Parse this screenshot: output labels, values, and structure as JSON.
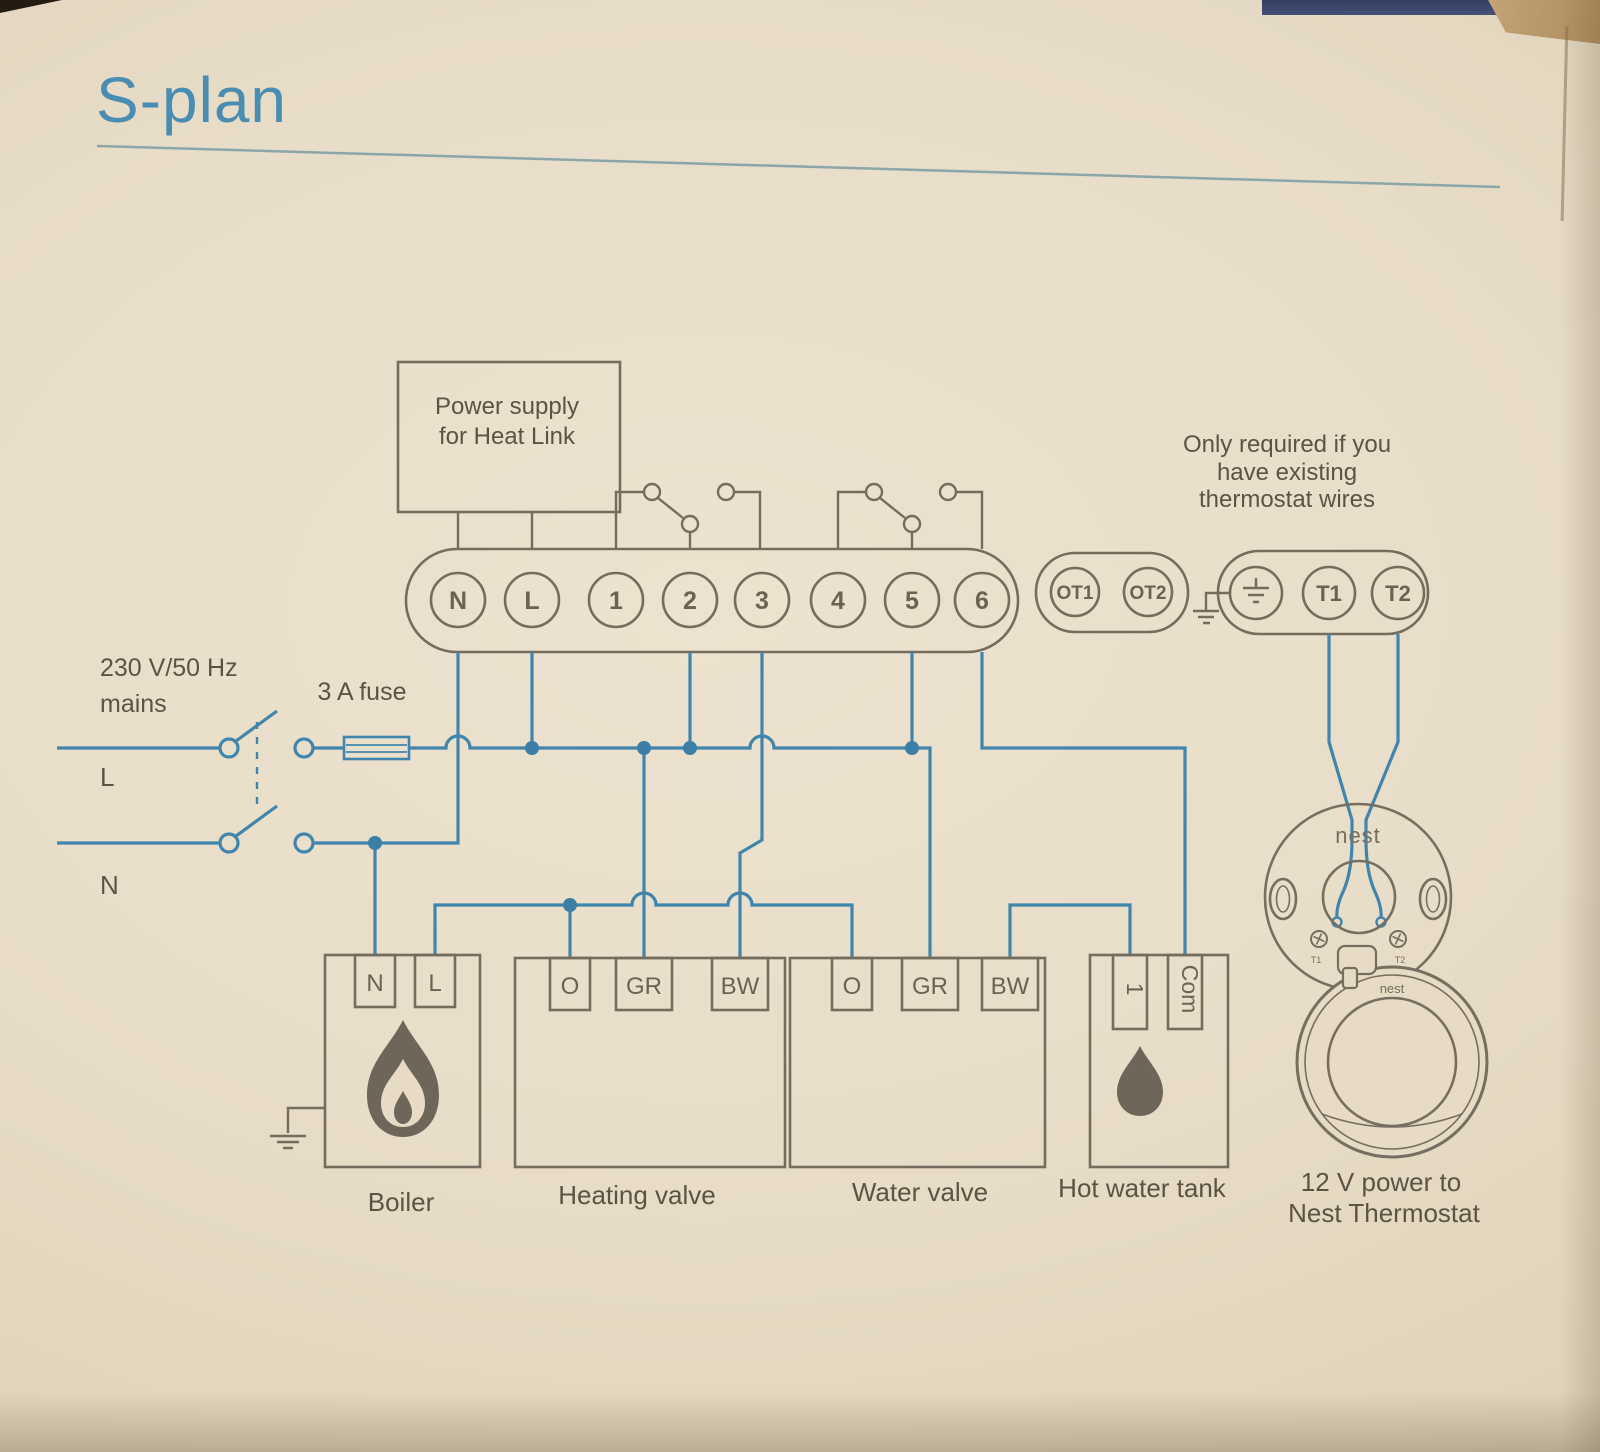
{
  "title": "S-plan",
  "colors": {
    "wire_blue": "#4085ab",
    "line_gray": "#746c5c",
    "text_gray": "#5b5344",
    "title_blue": "#4a8db2",
    "paper": "#e7dbc5"
  },
  "heat_link": {
    "power_supply": {
      "line1": "Power supply",
      "line2": "for Heat Link"
    },
    "terminals": [
      "N",
      "L",
      "1",
      "2",
      "3",
      "4",
      "5",
      "6"
    ],
    "ot_terminals": [
      "OT1",
      "OT2"
    ],
    "t_terminals": [
      "T1",
      "T2"
    ]
  },
  "note": {
    "line1": "Only required if you",
    "line2": "have existing",
    "line3": "thermostat wires"
  },
  "mains": {
    "voltage": "230 V/50 Hz",
    "label": "mains",
    "live": "L",
    "neutral": "N",
    "fuse": "3 A fuse"
  },
  "boiler": {
    "label": "Boiler",
    "terminal_n": "N",
    "terminal_l": "L"
  },
  "heating_valve": {
    "label": "Heating valve",
    "terminals": [
      "O",
      "GR",
      "BW"
    ]
  },
  "water_valve": {
    "label": "Water valve",
    "terminals": [
      "O",
      "GR",
      "BW"
    ]
  },
  "hot_water_tank": {
    "label": "Hot water tank",
    "terminal_1": "1",
    "terminal_com": "Com"
  },
  "nest": {
    "backplate_logo": "nest",
    "thermostat_logo": "nest",
    "screw_label_t1": "T1",
    "screw_label_t2": "T2",
    "power_line1": "12 V power to",
    "power_line2": "Nest Thermostat"
  }
}
